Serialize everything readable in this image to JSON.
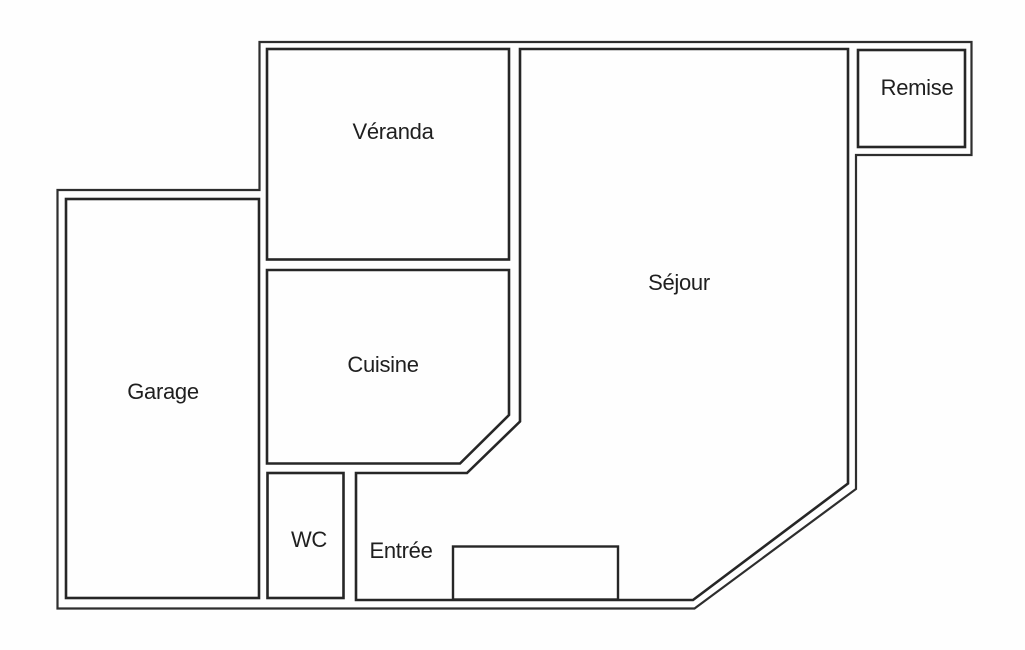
{
  "plan": {
    "title": "Floor plan",
    "background_color": "#fefefe",
    "wall_color": "#262626",
    "outer_wall_color": "#2e2e2e",
    "text_color": "#1f1f1f",
    "rooms": [
      {
        "id": "veranda",
        "label": "Véranda"
      },
      {
        "id": "remise",
        "label": "Remise"
      },
      {
        "id": "sejour",
        "label": "Séjour"
      },
      {
        "id": "garage",
        "label": "Garage"
      },
      {
        "id": "cuisine",
        "label": "Cuisine"
      },
      {
        "id": "wc",
        "label": "WC"
      },
      {
        "id": "entree",
        "label": "Entrée"
      }
    ]
  }
}
